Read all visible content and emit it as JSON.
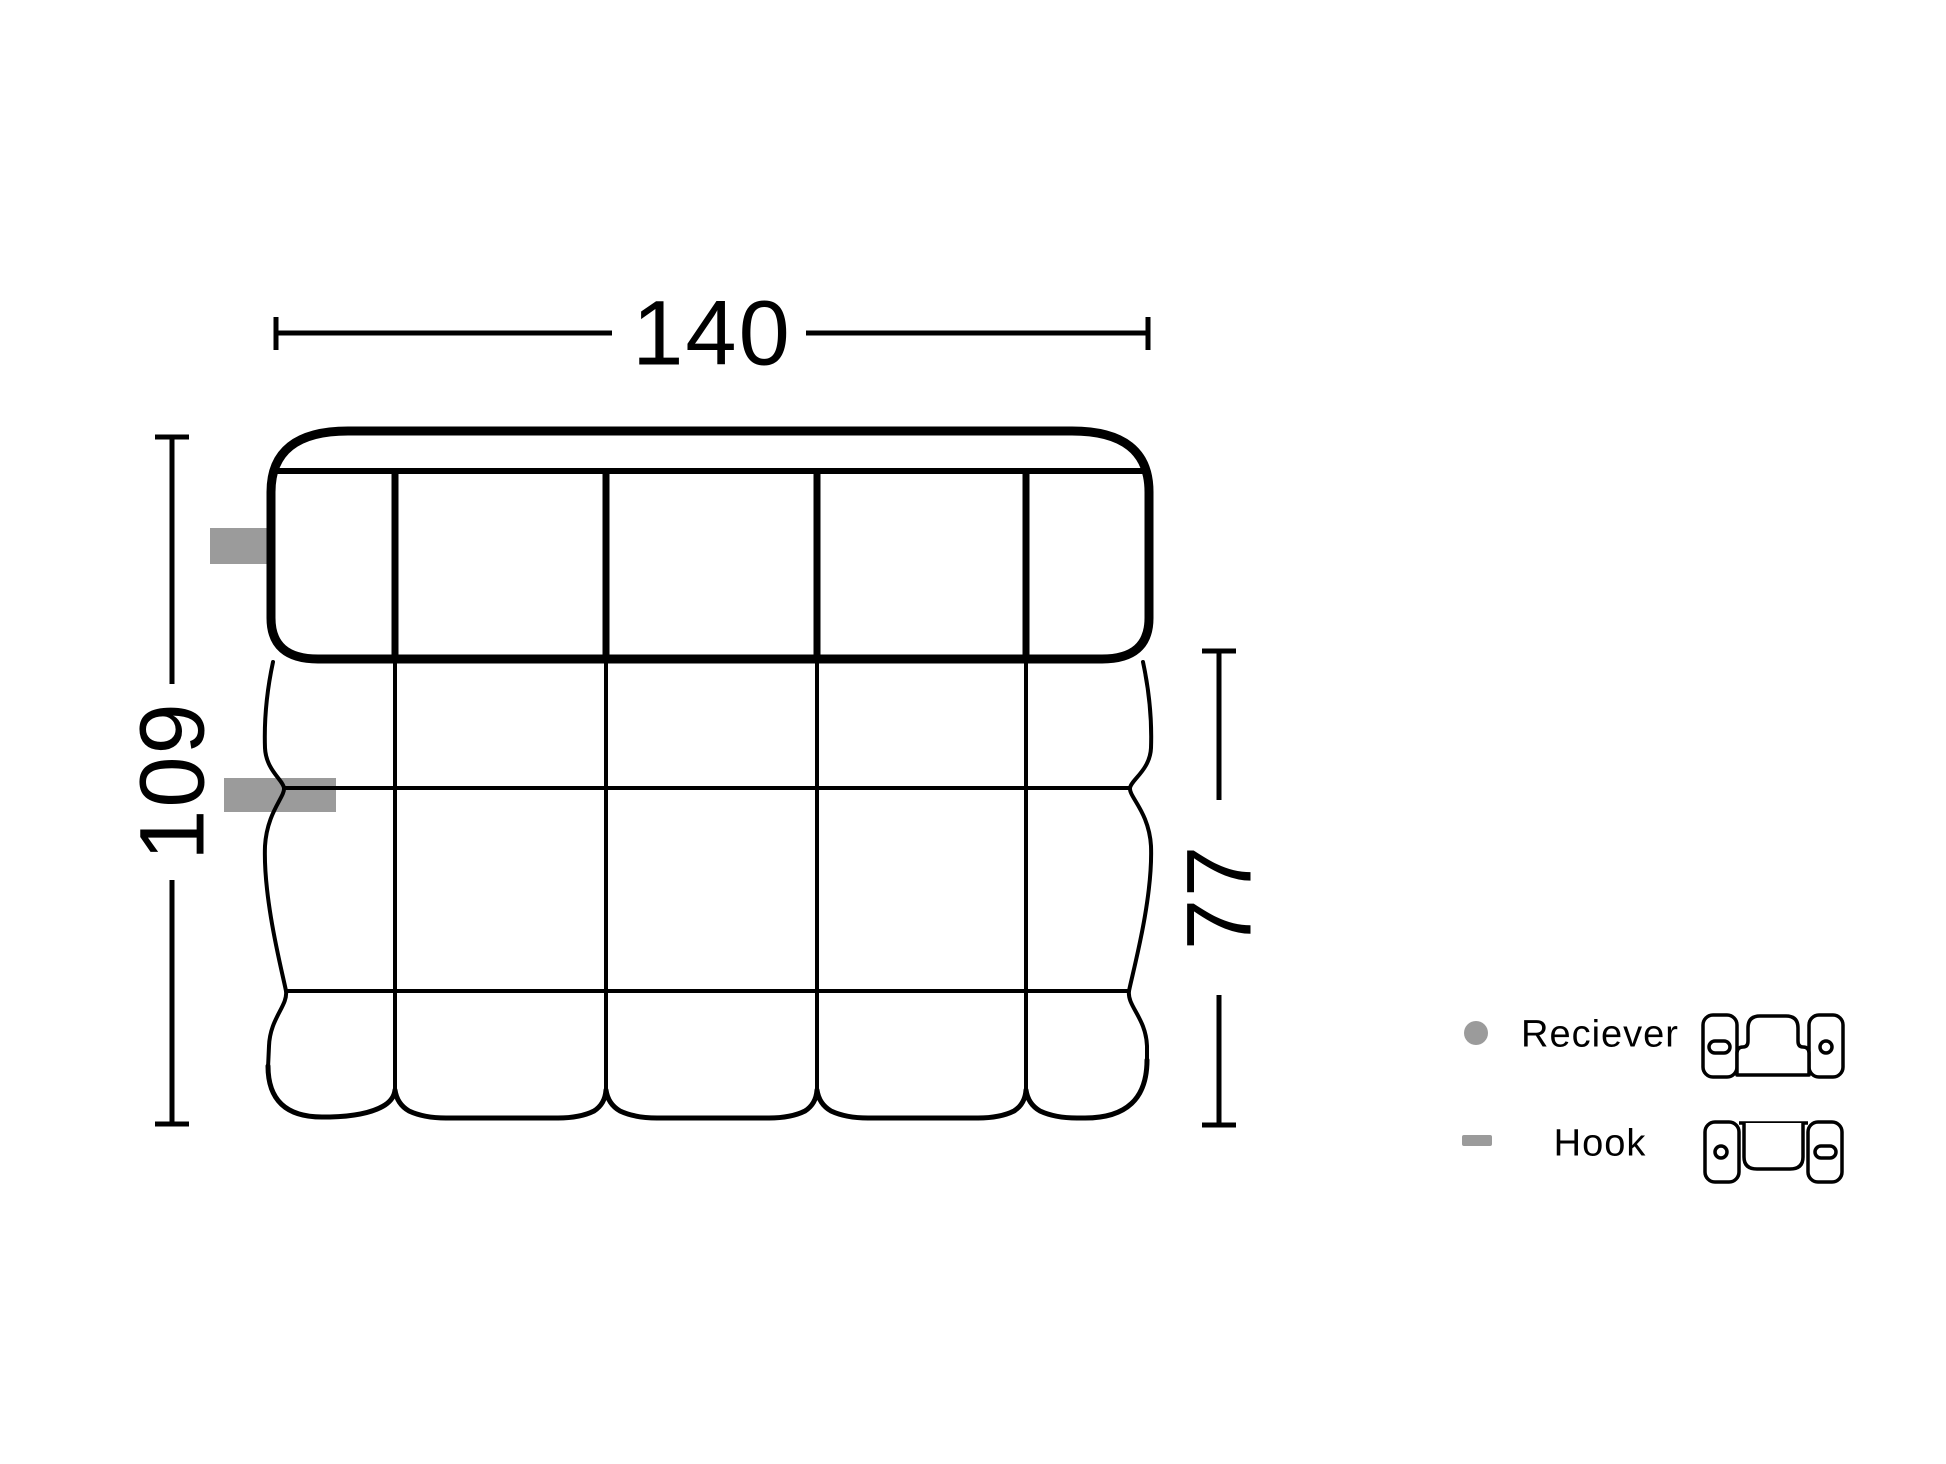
{
  "diagram": {
    "type": "furniture-dimension-drawing",
    "dimensions": {
      "width": "140",
      "depth": "109",
      "seat_depth": "77"
    },
    "legend": {
      "receiver": {
        "label": "Reciever",
        "marker": "dot"
      },
      "hook": {
        "label": "Hook",
        "marker": "dash"
      }
    },
    "colors": {
      "line": "#000000",
      "marker_gray": "#9b9b9b",
      "background": "#ffffff"
    }
  }
}
